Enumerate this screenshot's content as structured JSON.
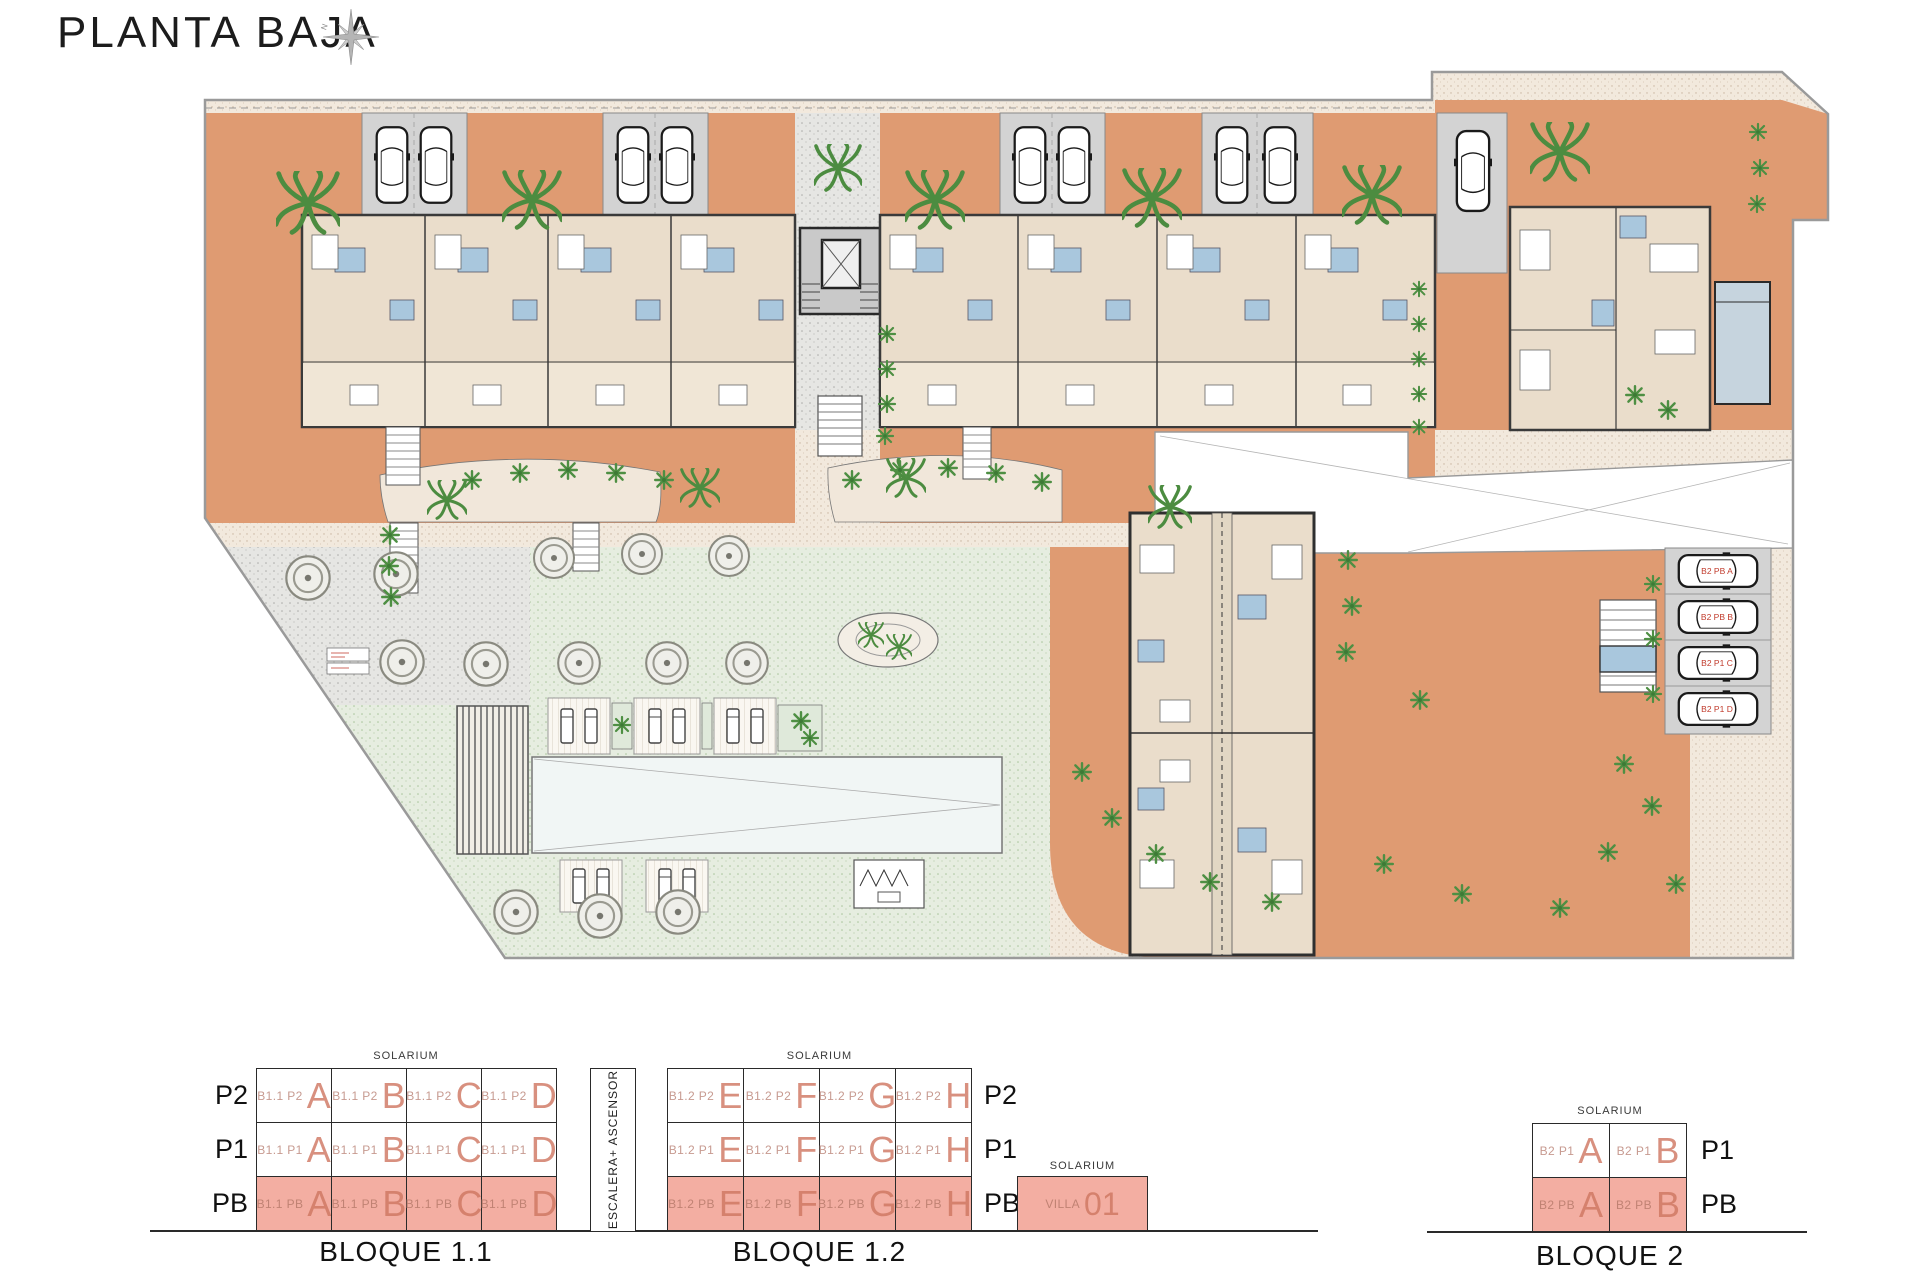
{
  "title": "PLANTA BAJA",
  "compass_north": "N",
  "palette": {
    "terracotta_terrace": "#DF9B72",
    "building_interior": "#EADDCB",
    "terrace_light": "#F0E6D6",
    "parking_gray": "#D3D3D3",
    "bathroom_blue": "#A9C7DD",
    "lawn_green": "#E6EDE0",
    "pool_white": "#F1F6F5",
    "villa_pool_blue": "#C6D4DE",
    "highlight_pink": "#F3AEA2",
    "unit_letter_salmon": "#D8907F",
    "unit_prefix": "#C79A90",
    "parking_label_red": "#C03A2B",
    "plant_green": "#4E8F43",
    "wall_dark": "#3A3A3A"
  },
  "plan": {
    "parking_labels": [
      "B2 PB A",
      "B2 PB B",
      "B2 P1 C",
      "B2 P1 D"
    ]
  },
  "diagrams": {
    "stair_core_label": "ESCALERA+ ASCENSOR",
    "bloque_1_1": {
      "solarium": "SOLARIUM",
      "title": "BLOQUE 1.1",
      "rows": [
        {
          "label": "P2",
          "cells": [
            {
              "p": "B1.1 P2",
              "l": "A"
            },
            {
              "p": "B1.1 P2",
              "l": "B"
            },
            {
              "p": "B1.1 P2",
              "l": "C"
            },
            {
              "p": "B1.1 P2",
              "l": "D"
            }
          ]
        },
        {
          "label": "P1",
          "cells": [
            {
              "p": "B1.1 P1",
              "l": "A"
            },
            {
              "p": "B1.1 P1",
              "l": "B"
            },
            {
              "p": "B1.1 P1",
              "l": "C"
            },
            {
              "p": "B1.1 P1",
              "l": "D"
            }
          ]
        },
        {
          "label": "PB",
          "cells": [
            {
              "p": "B1.1 PB",
              "l": "A"
            },
            {
              "p": "B1.1 PB",
              "l": "B"
            },
            {
              "p": "B1.1 PB",
              "l": "C"
            },
            {
              "p": "B1.1 PB",
              "l": "D"
            }
          ]
        }
      ]
    },
    "bloque_1_2": {
      "solarium": "SOLARIUM",
      "title": "BLOQUE 1.2",
      "rows": [
        {
          "label": "P2",
          "cells": [
            {
              "p": "B1.2 P2",
              "l": "E"
            },
            {
              "p": "B1.2 P2",
              "l": "F"
            },
            {
              "p": "B1.2 P2",
              "l": "G"
            },
            {
              "p": "B1.2 P2",
              "l": "H"
            }
          ]
        },
        {
          "label": "P1",
          "cells": [
            {
              "p": "B1.2 P1",
              "l": "E"
            },
            {
              "p": "B1.2 P1",
              "l": "F"
            },
            {
              "p": "B1.2 P1",
              "l": "G"
            },
            {
              "p": "B1.2 P1",
              "l": "H"
            }
          ]
        },
        {
          "label": "PB",
          "cells": [
            {
              "p": "B1.2 PB",
              "l": "E"
            },
            {
              "p": "B1.2 PB",
              "l": "F"
            },
            {
              "p": "B1.2 PB",
              "l": "G"
            },
            {
              "p": "B1.2 PB",
              "l": "H"
            }
          ]
        }
      ]
    },
    "villa": {
      "solarium": "SOLARIUM",
      "name": "VILLA",
      "number": "01"
    },
    "bloque_2": {
      "solarium": "SOLARIUM",
      "title": "BLOQUE 2",
      "rows": [
        {
          "label": "P1",
          "cells": [
            {
              "p": "B2 P1",
              "l": "A"
            },
            {
              "p": "B2 P1",
              "l": "B"
            }
          ]
        },
        {
          "label": "PB",
          "cells": [
            {
              "p": "B2 PB",
              "l": "A"
            },
            {
              "p": "B2 PB",
              "l": "B"
            }
          ]
        }
      ]
    }
  }
}
